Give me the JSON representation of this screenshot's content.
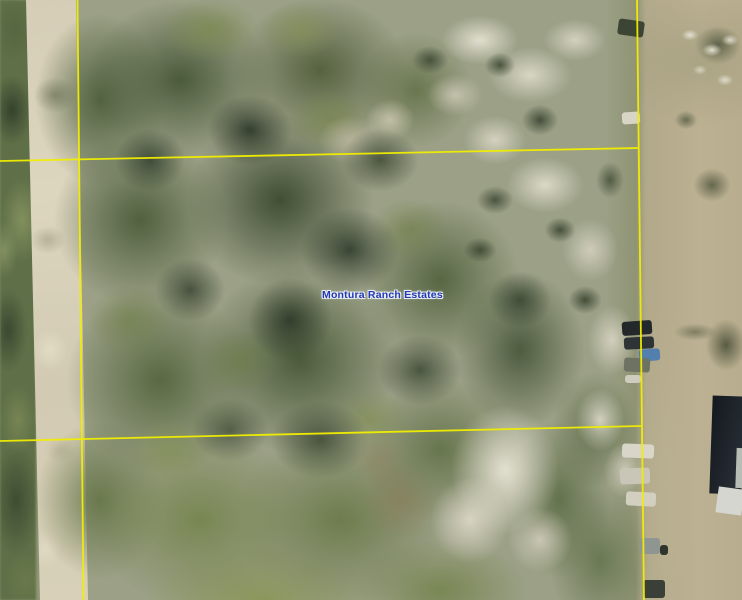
{
  "map": {
    "place_label": "Montura Ranch Estates",
    "colors": {
      "parcel_line": "#f2ee00",
      "label_text": "#2439b2",
      "label_halo": "#e7edf4"
    },
    "features": [
      "dirt-road",
      "tree-canopy",
      "sand-clearing",
      "scrub-field",
      "parcel-boundary-lines",
      "parked-vehicles",
      "building-roof"
    ]
  }
}
